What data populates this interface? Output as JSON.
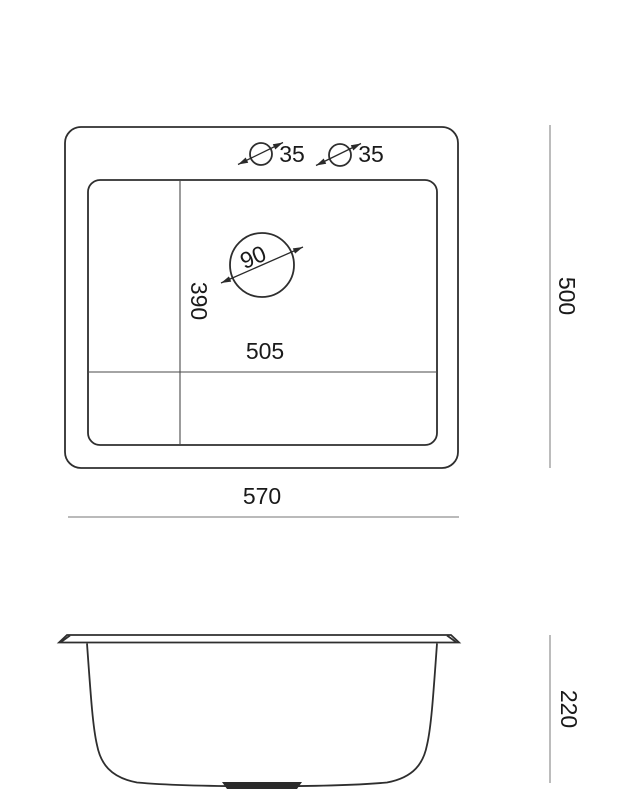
{
  "top_view": {
    "faucet_hole_1_diameter": "35",
    "faucet_hole_2_diameter": "35",
    "drain_diameter": "90",
    "inner_depth": "390",
    "inner_width": "505"
  },
  "dimensions": {
    "overall_width": "570",
    "overall_depth": "500",
    "side_height": "220"
  },
  "colors": {
    "outline": "#2e2e2e",
    "divider": "#4a4a4a",
    "dimension_line": "#909090",
    "text": "#1a1a1a",
    "background": "#ffffff"
  }
}
